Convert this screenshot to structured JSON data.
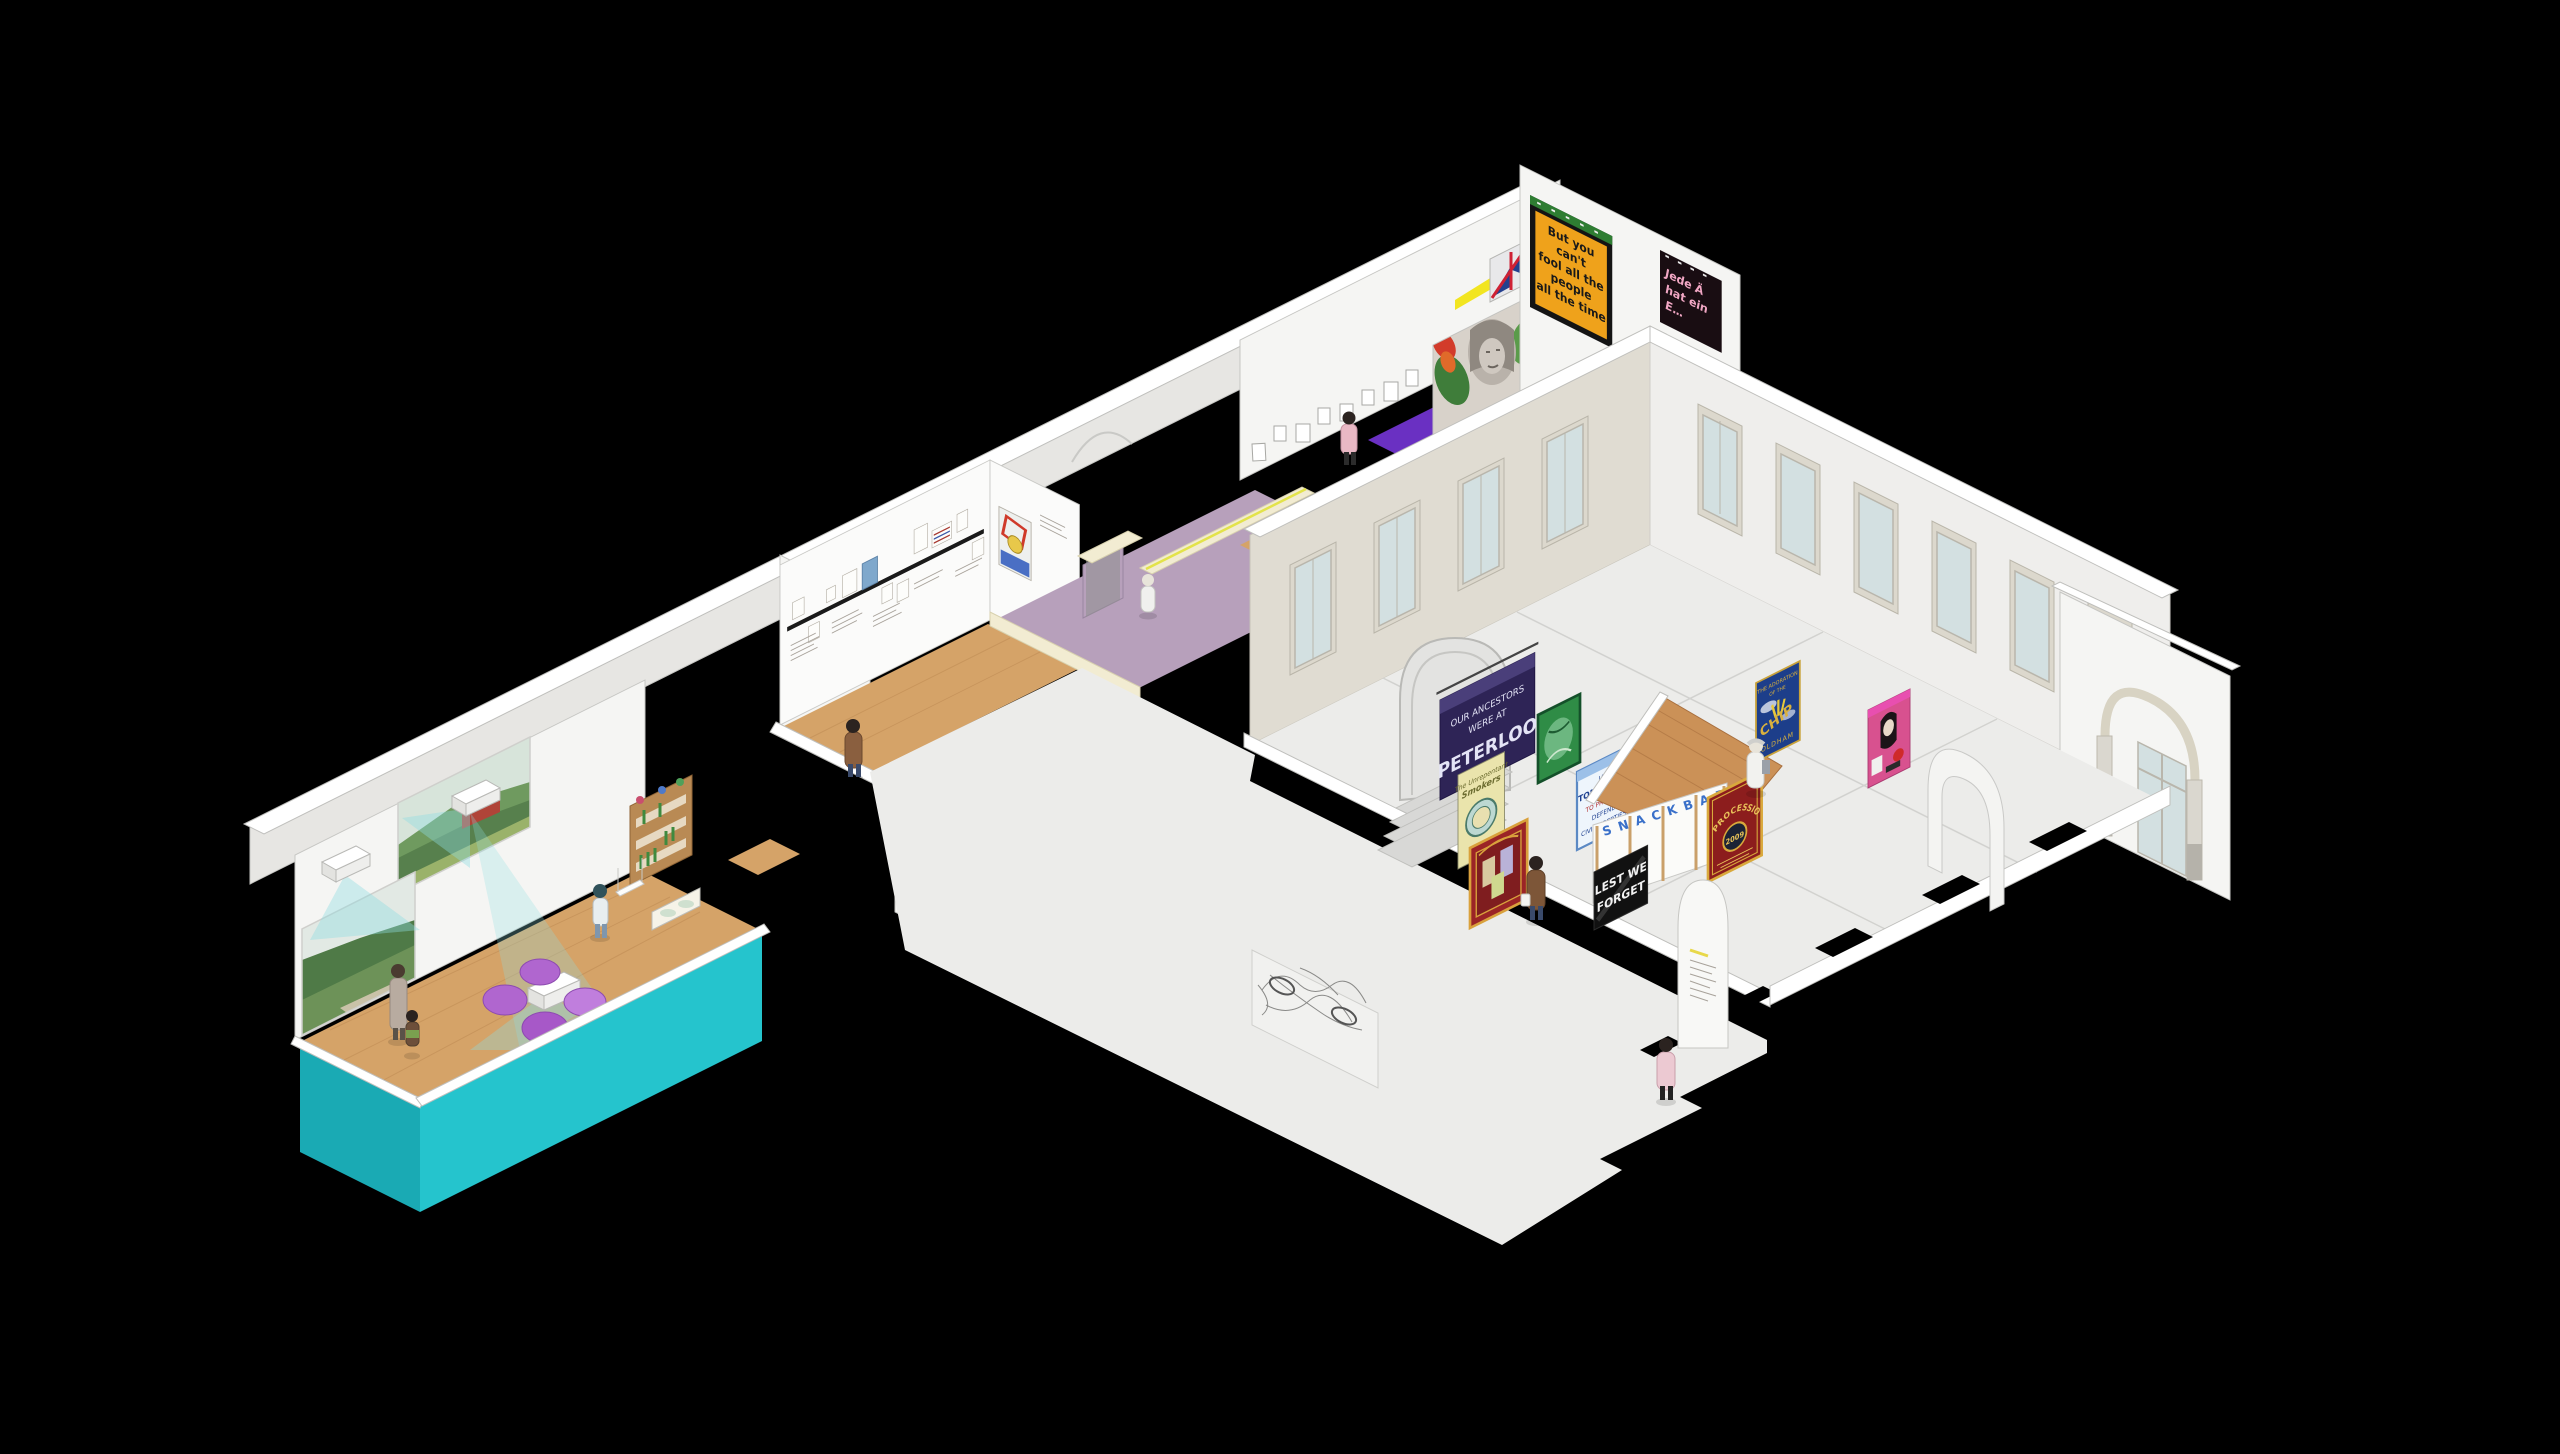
{
  "scene": {
    "description": "Isometric cutaway rendering of a museum exhibition floor on black background",
    "background": "#000000"
  },
  "colors": {
    "wall_white": "#f5f5f3",
    "wall_shade": "#e7e6e3",
    "wall_beige": "#e0dcd2",
    "cream_cap": "#f2ecd2",
    "wood_floor": "#d5a368",
    "wood_dark": "#b9854e",
    "hall_floor": "#ececea",
    "mauve_floor": "#b7a0bb",
    "purple_rug": "#6a30c2",
    "teal_wall": "#25c4cd",
    "teal_dark": "#1aaab4",
    "projection_beam": "#8fdde2",
    "beanbag_purple": "#b066cf",
    "glass": "#d3e0e1",
    "banner_yellow": "#efa21b",
    "banner_green": "#2f8c46",
    "banner_indigo": "#2e2456",
    "banner_red": "#9b2426",
    "banner_crimson": "#8c1d1d",
    "banner_blue": "#1d3e8a",
    "banner_pink": "#d8518f",
    "banner_cream": "#eae4ac",
    "gold": "#d9a93c",
    "snack_roof": "#cb9157",
    "sign_blue": "#3a70c9",
    "black_sign": "#111111"
  },
  "artworks": {
    "fool_banner": {
      "lines": [
        "But you",
        "can't",
        "fool all the",
        "people",
        "all the time"
      ]
    },
    "jede_poster": {
      "lines": [
        "Jede Ä",
        "hat ein",
        "E…"
      ]
    },
    "peterloo_banner": {
      "lines": [
        "OUR ANCESTORS",
        "WERE AT",
        "PETERLOO"
      ]
    },
    "smokers_banner": {
      "lines": [
        "The Unrepentant",
        "Smokers"
      ]
    },
    "tomlinson_banner": {
      "lines": [
        "IAN",
        "TOMLINSON",
        "TO PROTEST",
        "DEFEND",
        "CIVIL LIBERTIES"
      ]
    },
    "procession_banner": {
      "title": "PROCESSION",
      "year": "2009"
    },
    "chip_banner": {
      "lines": [
        "THE ADORATION",
        "OF THE",
        "CHIP",
        "OLDHAM"
      ]
    },
    "snack_bar_sign": "S N A C K   B A R .",
    "lest_we_forget": {
      "lines": [
        "LEST WE",
        "FORGET"
      ]
    }
  },
  "people": [
    {
      "location": "upper corridor",
      "outfit": "pink coat"
    },
    {
      "location": "mauve gallery",
      "outfit": "white jacket"
    },
    {
      "location": "timeline gallery",
      "outfit": "brown coat"
    },
    {
      "location": "connector corridor",
      "outfit": "brown coat with white bag"
    },
    {
      "location": "projection room",
      "outfit": "headscarf and white top"
    },
    {
      "location": "projection room",
      "outfit": "long beige coat"
    },
    {
      "location": "projection room",
      "outfit": "child"
    },
    {
      "location": "main hall",
      "outfit": "brown coat with white bag"
    },
    {
      "location": "main hall",
      "outfit": "white outfit"
    },
    {
      "location": "main hall entrance",
      "outfit": "pink coat"
    }
  ]
}
